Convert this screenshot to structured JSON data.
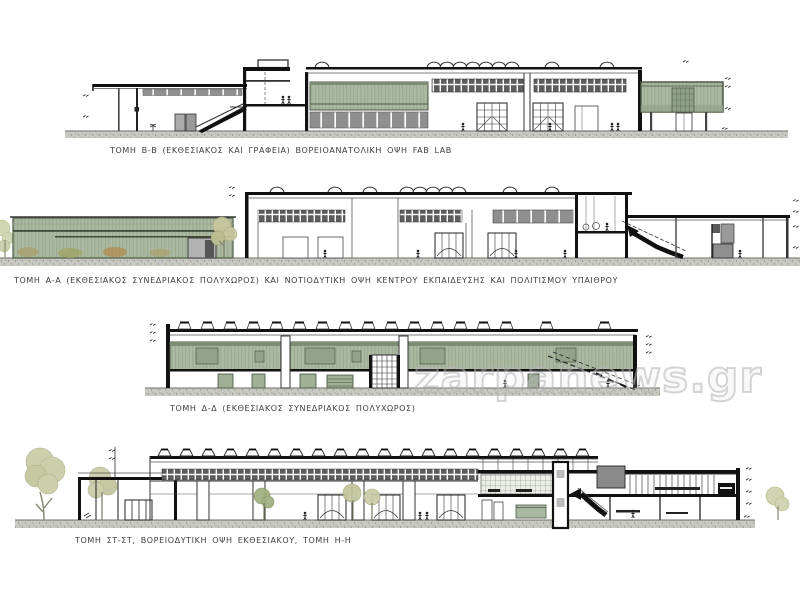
{
  "watermark": {
    "text": "zarpanews.gr"
  },
  "palette": {
    "glass_green": "#abb9a1",
    "frame_green": "#4e5a47",
    "panel_gray": "#8f8f8f",
    "line_dark": "#1a1a1a",
    "ground_gray": "#c9c9c3",
    "caption_gray": "#3d3d3d",
    "tree_olive": "#c9cba6"
  },
  "drawings": [
    {
      "id": "section-b-b",
      "caption": "ΤΟΜΗ Β-Β (ΕΚΘΕΣΙΑΚΟΣ  ΚΑΙ ΓΡΑΦΕΙΑ)  ΒΟΡΕΙΟΑΝΑΤΟΛΙΚΗ  ΟΨΗ FAB LAB"
    },
    {
      "id": "section-a-a",
      "caption": "ΤΟΜΗ  Α-Α (ΕΚΘΕΣΙΑΚΟΣ  ΣΥΝΕΔΡΙΑΚΟΣ  ΠΟΛΥΧΩΡΟΣ)  ΚΑΙ ΝΟΤΙΟΔΥΤΙΚΗ  ΟΨΗ  ΚΕΝΤΡΟΥ  ΕΚΠΑΙΔΕΥΣΗΣ  ΚΑΙ ΠΟΛΙΤΙΣΜΟΥ  ΥΠΑΙΘΡΟΥ"
    },
    {
      "id": "section-d-d",
      "caption": "ΤΟΜΗ  Δ-Δ (ΕΚΘΕΣΙΑΚΟΣ  ΣΥΝΕΔΡΙΑΚΟΣ  ΠΟΛΥΧΩΡΟΣ)"
    },
    {
      "id": "section-st-st",
      "caption": "ΤΟΜΗ  ΣΤ-ΣΤ,  ΒΟΡΕΙΟΔΥΤΙΚΗ  ΟΨΗ ΕΚΘΕΣΙΑΚΟΥ,  ΤΟΜΗ  Η-Η"
    }
  ]
}
